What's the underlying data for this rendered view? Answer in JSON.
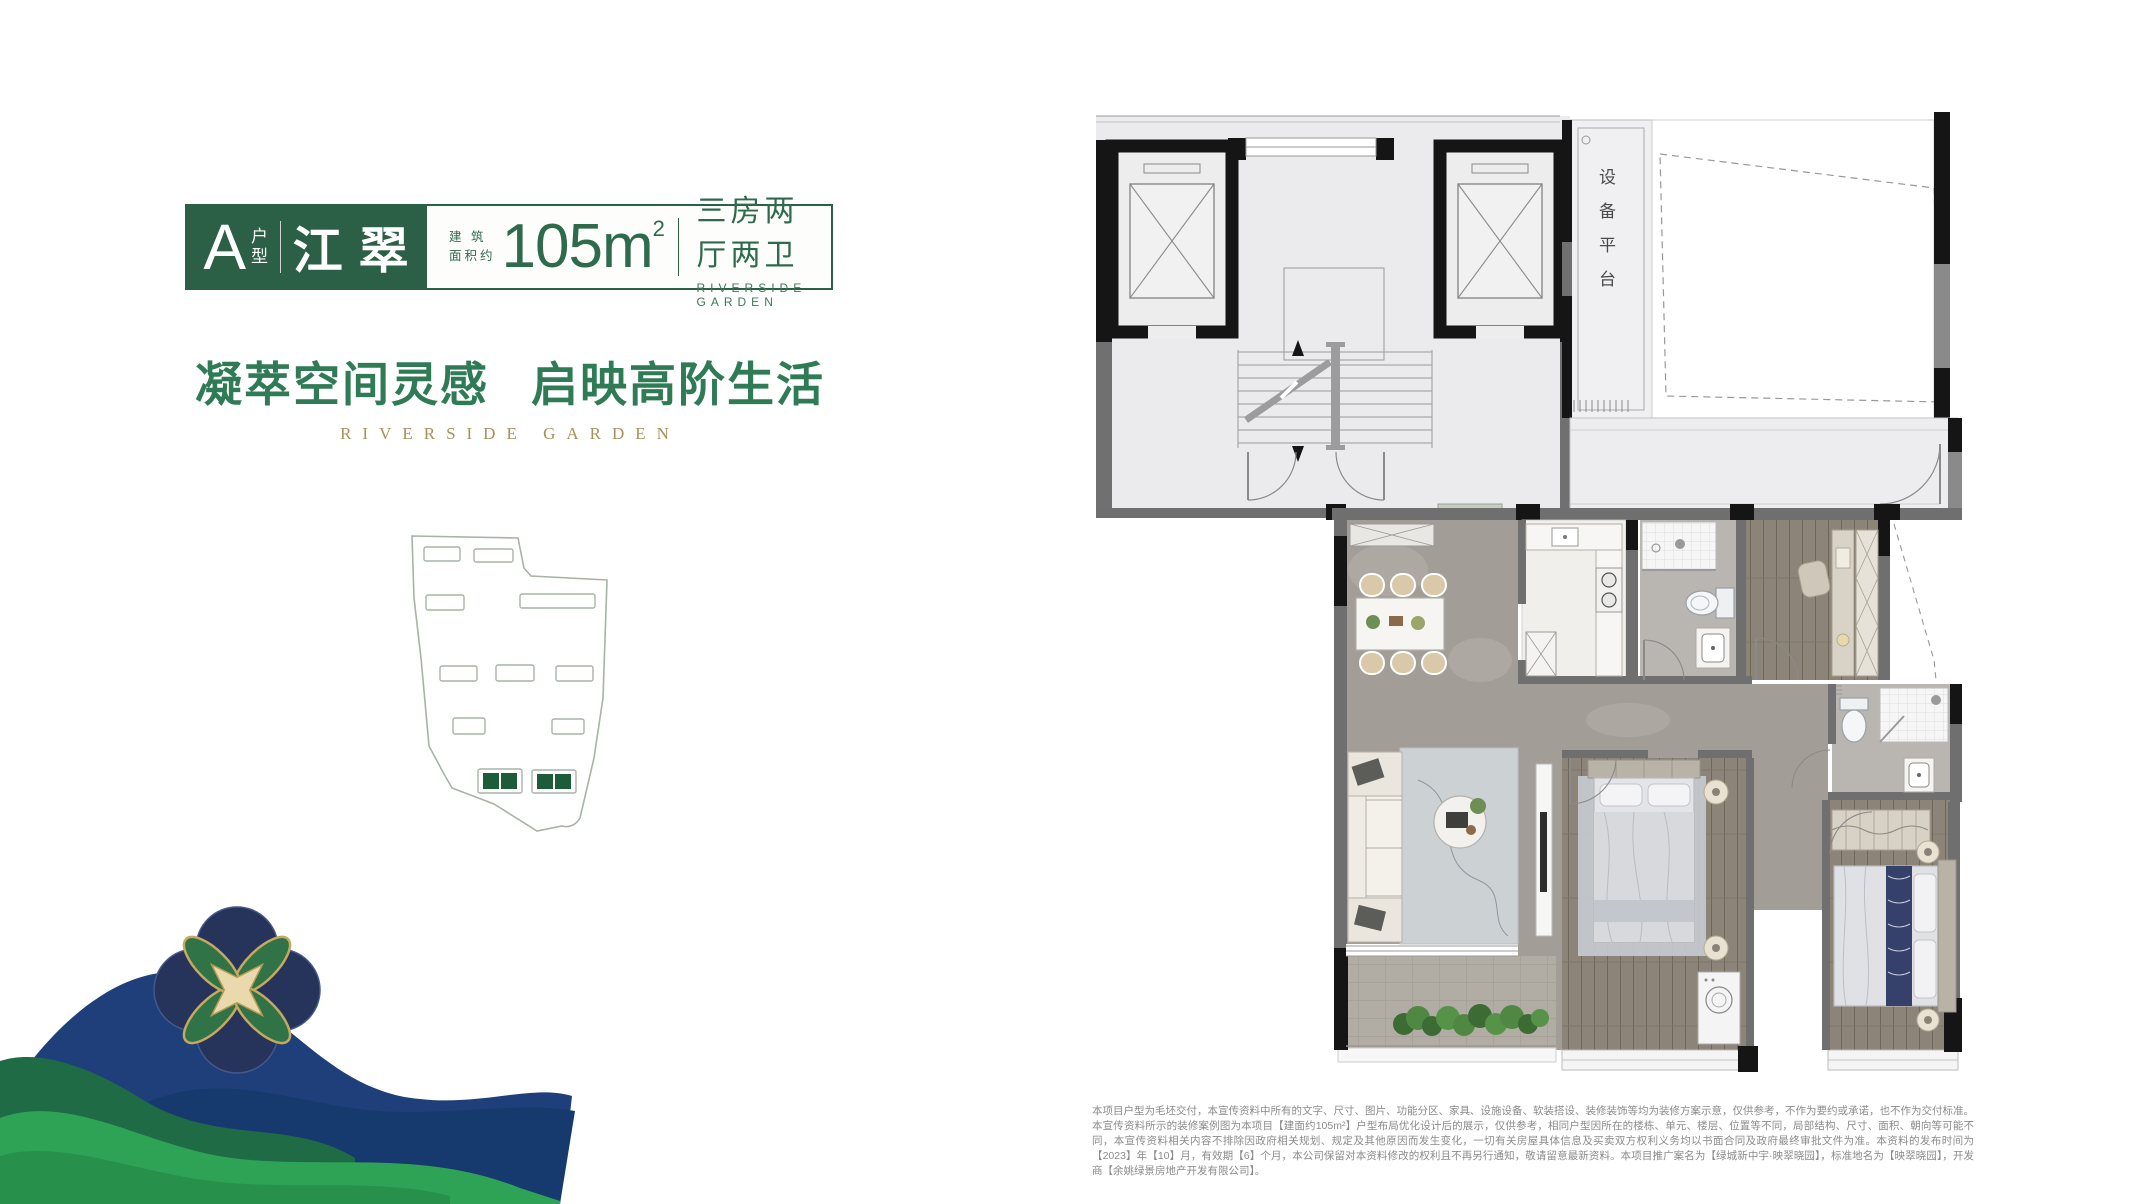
{
  "badge": {
    "type_letter": "A",
    "type_suffix": "户型",
    "name": "江翠",
    "area_label_line1": "建 筑",
    "area_label_line2": "面积约",
    "area_value": "105m",
    "area_exponent": "2",
    "layout_text": "三房两厅两卫",
    "layout_subtext": "RIVERSIDE GARDEN"
  },
  "slogan": {
    "headline_part1": "凝萃空间灵感",
    "headline_part2": "启映高阶生活",
    "subtitle": "RIVERSIDE GARDEN"
  },
  "floorplan": {
    "equipment_platform_label": "设备平台"
  },
  "disclaimer": {
    "text": "本项目户型为毛坯交付，本宣传资料中所有的文字、尺寸、图片、功能分区、家具、设施设备、软装搭设、装修装饰等均为装修方案示意，仅供参考，不作为要约或承诺，也不作为交付标准。本宣传资料所示的装修案例图为本项目【建面约105m²】户型布局优化设计后的展示，仅供参考，相同户型因所在的楼栋、单元、楼层、位置等不同，局部结构、尺寸、面积、朝向等可能不同，本宣传资料相关内容不排除因政府相关规划、规定及其他原因而发生变化，一切有关房屋具体信息及买卖双方权利义务均以书面合同及政府最终审批文件为准。本资料的发布时间为【2023】年【10】月，有效期【6】个月，本公司保留对本资料修改的权利且不再另行通知，敬请留意最新资料。本项目推广案名为【绿城新中宇·映翠晓园】，标准地名为【映翠晓园】，开发商【余姚绿景房地产开发有限公司】。"
  },
  "colors": {
    "badge_green": "#2b5f46",
    "slogan_green": "#2e7b55",
    "gold": "#a8905a",
    "site_highlight_green": "#1d5c38",
    "wall_black": "#151515",
    "wall_gray": "#6f6f6f"
  }
}
